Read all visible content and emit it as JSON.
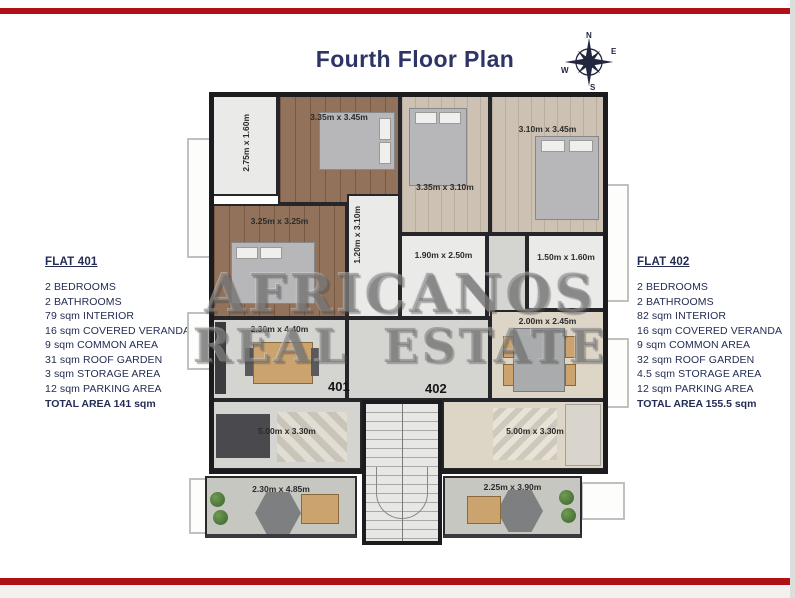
{
  "slide": {
    "title": "Fourth Floor Plan",
    "accent_red": "#b01117",
    "navy_text": "#232d54",
    "title_color": "#2e3566"
  },
  "compass": {
    "n": "N",
    "e": "E",
    "s": "S",
    "w": "W"
  },
  "flat401": {
    "title": "FLAT 401",
    "specs": [
      "2 BEDROOMS",
      "2 BATHROOMS",
      "79 sqm INTERIOR",
      "16 sqm COVERED VERANDA",
      "9 sqm COMMON AREA",
      "31 sqm ROOF GARDEN",
      "3 sqm STORAGE AREA",
      "12 sqm PARKING AREA"
    ],
    "total": "TOTAL AREA 141 sqm"
  },
  "flat402": {
    "title": "FLAT 402",
    "specs": [
      "2 BEDROOMS",
      "2 BATHROOMS",
      "82 sqm INTERIOR",
      "16 sqm COVERED VERANDA",
      "9 sqm COMMON AREA",
      "32 sqm ROOF GARDEN",
      "4.5 sqm STORAGE AREA",
      "12 sqm PARKING AREA"
    ],
    "total": "TOTAL AREA 155.5 sqm"
  },
  "plan": {
    "unit401": "401",
    "unit402": "402",
    "dims": {
      "bath1_401": "2.75m x 1.60m",
      "bed1_401": "3.35m x 3.45m",
      "bed2_401": "3.25m x 3.25m",
      "hall_401": "1.20m x 3.10m",
      "kitchen_401": "2.30m x 4.40m",
      "living_401": "5.00m x 3.30m",
      "veranda_401": "2.30m x 4.85m",
      "bed1_402": "3.35m x 3.10m",
      "bed2_402": "3.10m x 3.45m",
      "bath_402": "1.90m x 2.50m",
      "wc_402": "1.50m x 1.60m",
      "dining_402": "2.00m x 2.45m",
      "living_402": "5.00m x 3.30m",
      "veranda_402": "2.25m x 3.90m"
    }
  },
  "watermark": {
    "line1": "AFRICANOS",
    "line2": "REAL ESTATE"
  }
}
